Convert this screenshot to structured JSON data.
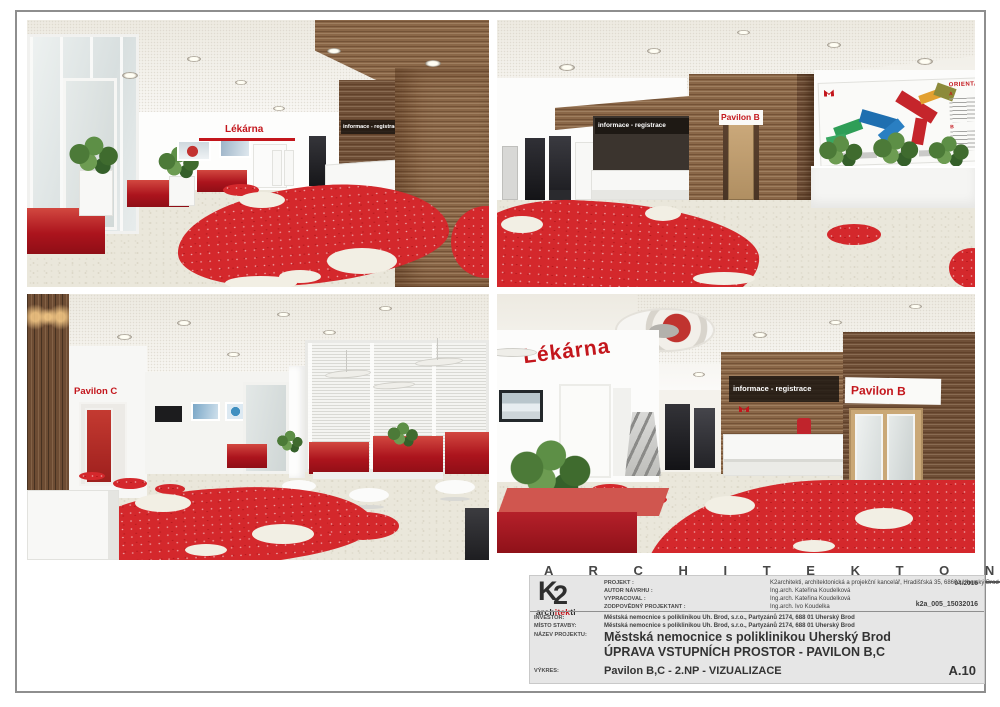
{
  "colors": {
    "brand_red": "#c3161c",
    "floor_red": "#d4282c",
    "wood_brown": "#8a6748",
    "titleblock_bg": "#e6e6e6",
    "sheet_border": "#8e8e8e"
  },
  "banner": {
    "title": "A R C H I T E K T O N I C K Á   S T U D I E"
  },
  "renders": {
    "top_left": {
      "signs": {
        "lekarna": "Lékárna",
        "info": "informace - registrace"
      }
    },
    "top_right": {
      "signs": {
        "info": "informace - registrace",
        "pavilon": "Pavilon B"
      },
      "orientation_board": {
        "title": "ORIENTAČ",
        "section_a": "A",
        "section_b": "B"
      }
    },
    "bottom_left": {
      "signs": {
        "pavilon": "Pavilon C"
      }
    },
    "bottom_right": {
      "signs": {
        "lekarna": "Lékárna",
        "info": "informace - registrace",
        "pavilon": "Pavilon B"
      }
    }
  },
  "titleblock": {
    "logo": {
      "k": "K",
      "two": "2",
      "sub1": "arch",
      "sub2": "itek",
      "sub3": "ti"
    },
    "rows_top": [
      {
        "label": "PROJEKT :",
        "value": "K2architekti, architektonická a projekční kancelář, Hradišťská 35, 68601 Uherský Brod",
        "right": "04/2016"
      },
      {
        "label": "AUTOR NÁVRHU :",
        "value": "Ing.arch. Kateřina Koudelková",
        "right": ""
      },
      {
        "label": "VYPRACOVAL :",
        "value": "Ing.arch. Kateřina Koudelková",
        "right": ""
      },
      {
        "label": "ZODPOVĚDNÝ PROJEKTANT :",
        "value": "Ing.arch. Ivo Koudelka",
        "right": "k2a_005_15032016"
      }
    ],
    "rows_mid": [
      {
        "label": "INVESTOR:",
        "value": "Městská nemocnice s poliklinikou Uh. Brod, s.r.o., Partyzánů 2174, 688 01 Uherský Brod"
      },
      {
        "label": "MÍSTO STAVBY:",
        "value": "Městská nemocnice s poliklinikou Uh. Brod, s.r.o., Partyzánů 2174, 688 01 Uherský Brod"
      }
    ],
    "project": {
      "label": "NÁZEV PROJEKTU:",
      "line1": "Městská nemocnice s poliklinikou Uherský Brod",
      "line2": "ÚPRAVA VSTUPNÍCH PROSTOR - PAVILON B,C"
    },
    "drawing": {
      "label": "VÝKRES:",
      "value": "Pavilon B,C - 2.NP - VIZUALIZACE",
      "number": "A.10"
    }
  }
}
